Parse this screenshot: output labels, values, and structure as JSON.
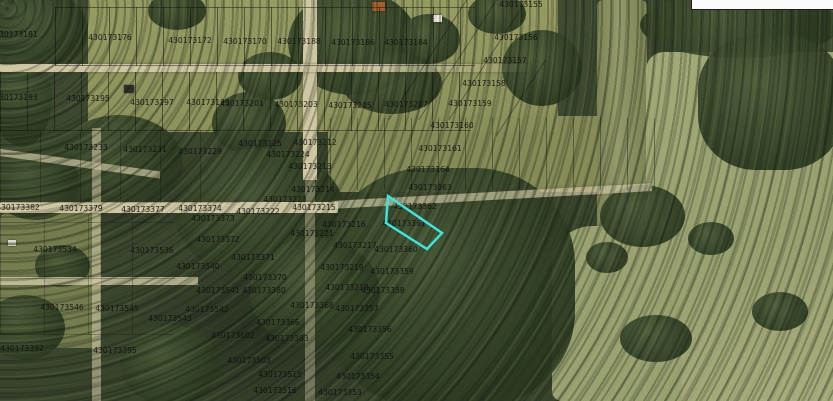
{
  "map": {
    "type": "aerial-parcel-map",
    "label_text_color": "#101010",
    "highlight": {
      "color": "#3BE5DF",
      "polygon_points": "388,196 442,233 427,249 386,223",
      "highlighted_parcel_id": "430173361"
    },
    "parcel_labels": [
      {
        "text": "430173181",
        "x": 16,
        "y": 35
      },
      {
        "text": "430173176",
        "x": 110,
        "y": 38
      },
      {
        "text": "430173172",
        "x": 190,
        "y": 41
      },
      {
        "text": "430173170",
        "x": 245,
        "y": 42
      },
      {
        "text": "430173188",
        "x": 299,
        "y": 42
      },
      {
        "text": "430173186",
        "x": 353,
        "y": 43
      },
      {
        "text": "430173184",
        "x": 406,
        "y": 43
      },
      {
        "text": "430173155",
        "x": 521,
        "y": 5
      },
      {
        "text": "430173156",
        "x": 516,
        "y": 38
      },
      {
        "text": "430173157",
        "x": 505,
        "y": 61
      },
      {
        "text": "430173158",
        "x": 484,
        "y": 84
      },
      {
        "text": "430173159",
        "x": 470,
        "y": 104
      },
      {
        "text": "430173193",
        "x": 16,
        "y": 98
      },
      {
        "text": "430173195",
        "x": 88,
        "y": 99
      },
      {
        "text": "430173197",
        "x": 152,
        "y": 103
      },
      {
        "text": "430173199",
        "x": 208,
        "y": 103
      },
      {
        "text": "430173201",
        "x": 242,
        "y": 104
      },
      {
        "text": "430173203",
        "x": 296,
        "y": 105
      },
      {
        "text": "430173205",
        "x": 350,
        "y": 106
      },
      {
        "text": "430173207",
        "x": 406,
        "y": 105
      },
      {
        "text": "430173160",
        "x": 452,
        "y": 126
      },
      {
        "text": "430173161",
        "x": 440,
        "y": 149
      },
      {
        "text": "430173164",
        "x": 428,
        "y": 170
      },
      {
        "text": "430173233",
        "x": 86,
        "y": 148
      },
      {
        "text": "430173231",
        "x": 145,
        "y": 150
      },
      {
        "text": "430173229",
        "x": 200,
        "y": 152
      },
      {
        "text": "430173225",
        "x": 260,
        "y": 144
      },
      {
        "text": "430173212",
        "x": 315,
        "y": 143
      },
      {
        "text": "430173224",
        "x": 288,
        "y": 155
      },
      {
        "text": "430173213",
        "x": 310,
        "y": 167
      },
      {
        "text": "430173214",
        "x": 313,
        "y": 190
      },
      {
        "text": "430173223",
        "x": 285,
        "y": 200
      },
      {
        "text": "430173222",
        "x": 258,
        "y": 212
      },
      {
        "text": "430173215",
        "x": 314,
        "y": 208
      },
      {
        "text": "430173216",
        "x": 344,
        "y": 225
      },
      {
        "text": "430173221",
        "x": 312,
        "y": 234
      },
      {
        "text": "430173217",
        "x": 355,
        "y": 246
      },
      {
        "text": "430173219",
        "x": 342,
        "y": 268
      },
      {
        "text": "430173218",
        "x": 347,
        "y": 288
      },
      {
        "text": "430173382",
        "x": 18,
        "y": 208
      },
      {
        "text": "430173379",
        "x": 81,
        "y": 209
      },
      {
        "text": "430173377",
        "x": 143,
        "y": 210
      },
      {
        "text": "430173374",
        "x": 200,
        "y": 209
      },
      {
        "text": "430173373",
        "x": 213,
        "y": 219
      },
      {
        "text": "430173372",
        "x": 218,
        "y": 240
      },
      {
        "text": "430173371",
        "x": 253,
        "y": 258
      },
      {
        "text": "430173370",
        "x": 265,
        "y": 278
      },
      {
        "text": "430173380",
        "x": 264,
        "y": 291
      },
      {
        "text": "430173540",
        "x": 198,
        "y": 267
      },
      {
        "text": "430173541",
        "x": 218,
        "y": 291
      },
      {
        "text": "430173542",
        "x": 207,
        "y": 310
      },
      {
        "text": "430173543",
        "x": 170,
        "y": 319
      },
      {
        "text": "430173534",
        "x": 55,
        "y": 250
      },
      {
        "text": "430173536",
        "x": 152,
        "y": 251
      },
      {
        "text": "430173546",
        "x": 62,
        "y": 308
      },
      {
        "text": "430173545",
        "x": 117,
        "y": 309
      },
      {
        "text": "430173392",
        "x": 22,
        "y": 349
      },
      {
        "text": "430173395",
        "x": 115,
        "y": 351
      },
      {
        "text": "430173602",
        "x": 233,
        "y": 336
      },
      {
        "text": "430173503",
        "x": 249,
        "y": 361
      },
      {
        "text": "430173515",
        "x": 280,
        "y": 375
      },
      {
        "text": "430173516",
        "x": 275,
        "y": 391
      },
      {
        "text": "430173383",
        "x": 287,
        "y": 339
      },
      {
        "text": "430173366",
        "x": 278,
        "y": 323
      },
      {
        "text": "430173368",
        "x": 312,
        "y": 306
      },
      {
        "text": "430173363",
        "x": 430,
        "y": 188
      },
      {
        "text": "430173362",
        "x": 415,
        "y": 207
      },
      {
        "text": "430173361",
        "x": 404,
        "y": 224
      },
      {
        "text": "430173360",
        "x": 396,
        "y": 250
      },
      {
        "text": "430173359",
        "x": 392,
        "y": 272
      },
      {
        "text": "430173358",
        "x": 383,
        "y": 291
      },
      {
        "text": "430173357",
        "x": 357,
        "y": 309
      },
      {
        "text": "430173356",
        "x": 370,
        "y": 330
      },
      {
        "text": "430173355",
        "x": 372,
        "y": 357
      },
      {
        "text": "430173354",
        "x": 358,
        "y": 377
      },
      {
        "text": "430173353",
        "x": 340,
        "y": 393
      }
    ]
  }
}
